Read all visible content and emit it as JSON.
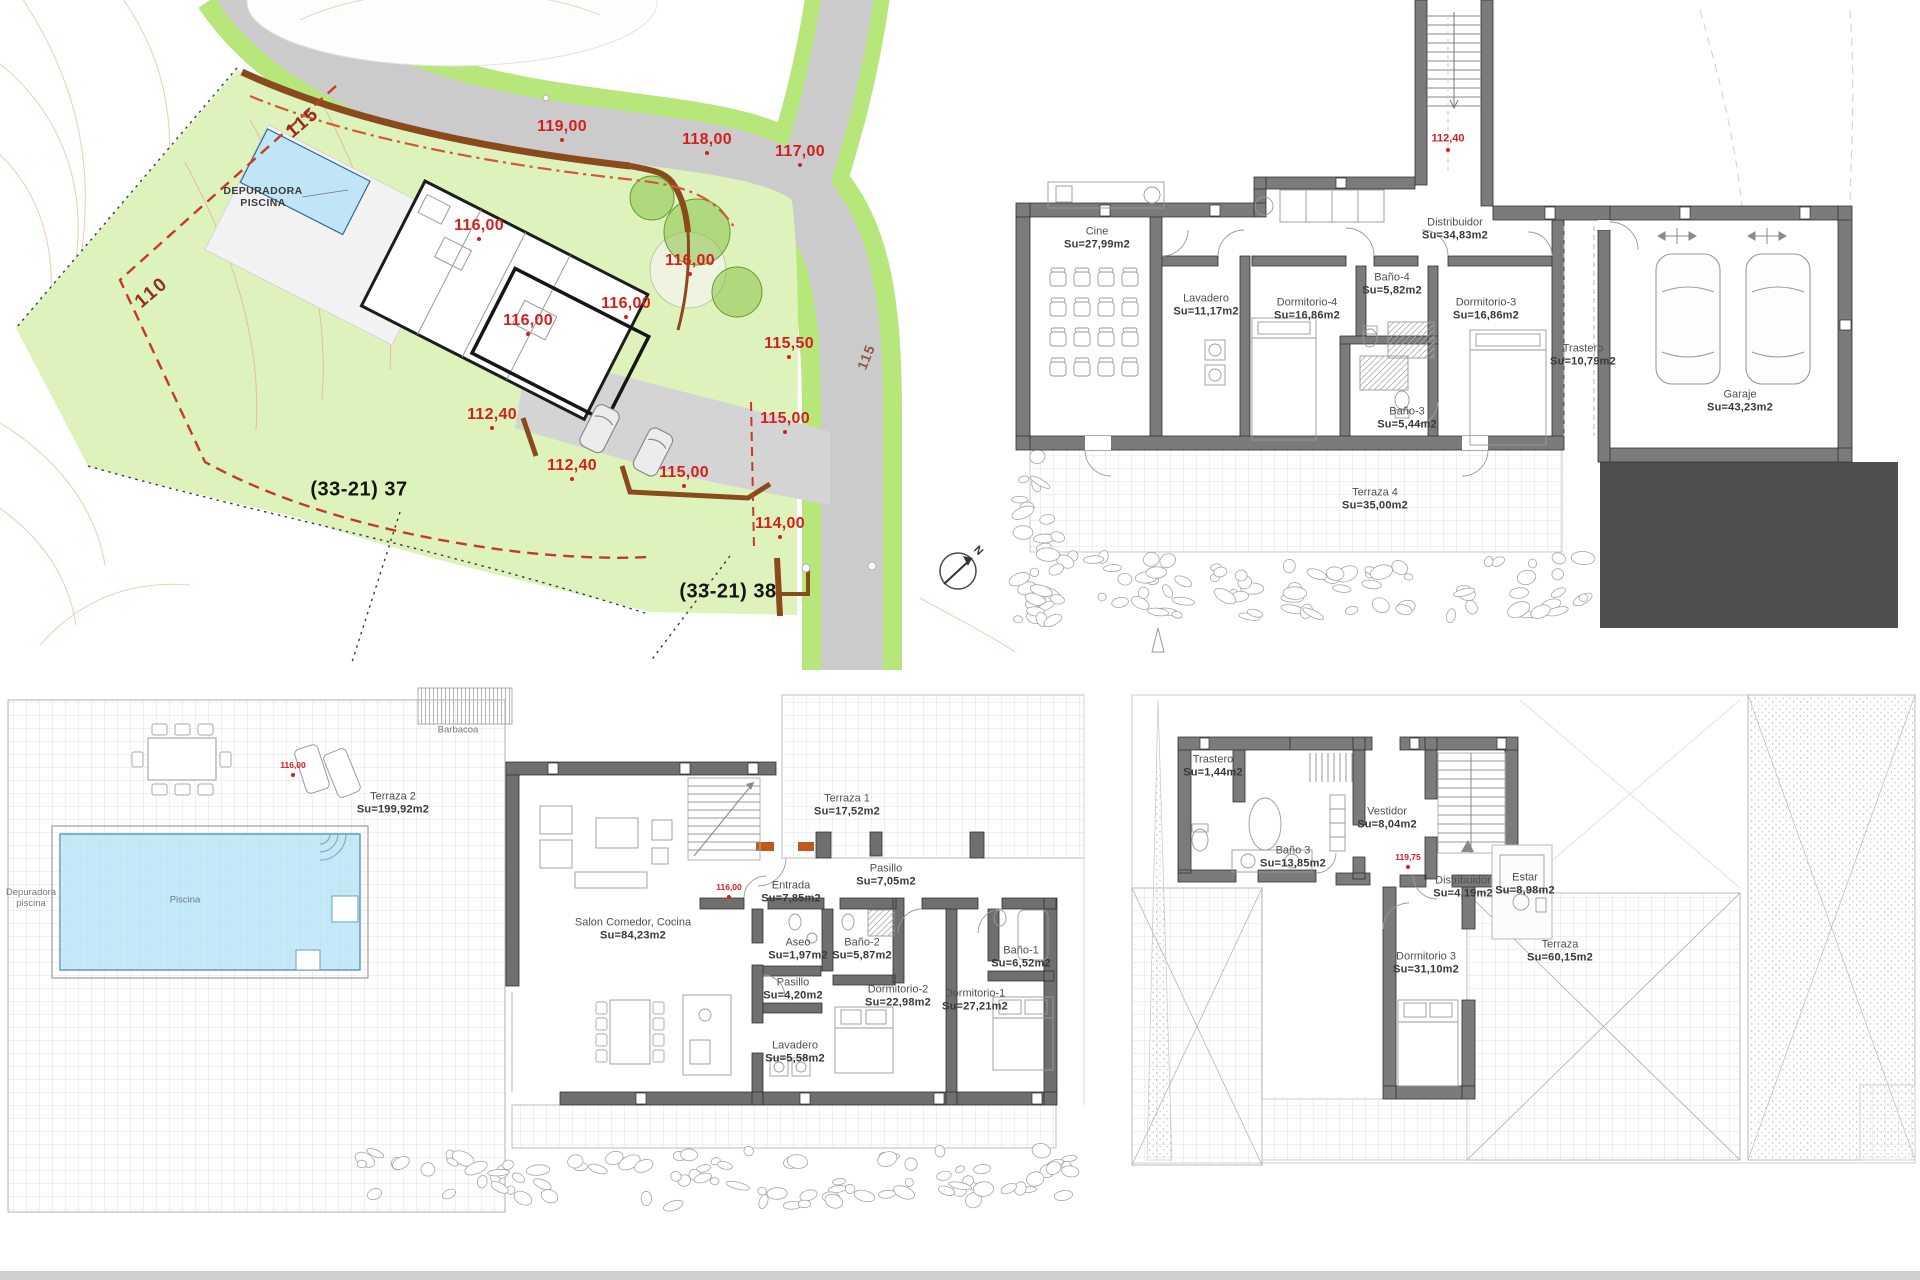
{
  "palette": {
    "plot_green": "#def2bb",
    "road_gray": "#cbcbcb",
    "verge_green": "#b7e67b",
    "pool_blue": "#bfe5f6",
    "wall_gray": "#7b7b7b",
    "retaining_brown": "#8a4a1c",
    "elevation_red": "#d42020",
    "boundary_red": "#c23b28",
    "dark_block": "#4f4f4f"
  },
  "labels": [
    {
      "t": "119,00",
      "x": 562,
      "y": 127,
      "c": "e",
      "n": "elevation-119"
    },
    {
      "t": "118,00",
      "x": 707,
      "y": 140,
      "c": "e",
      "n": "elevation-118"
    },
    {
      "t": "117,00",
      "x": 800,
      "y": 152,
      "c": "e",
      "n": "elevation-117"
    },
    {
      "t": "116,00",
      "x": 479,
      "y": 226,
      "c": "e",
      "n": "elevation-116-a"
    },
    {
      "t": "116,00",
      "x": 690,
      "y": 261,
      "c": "e",
      "n": "elevation-116-b"
    },
    {
      "t": "116,00",
      "x": 626,
      "y": 304,
      "c": "e",
      "n": "elevation-116-c"
    },
    {
      "t": "116,00",
      "x": 528,
      "y": 321,
      "c": "e",
      "n": "elevation-116-d"
    },
    {
      "t": "115,50",
      "x": 789,
      "y": 344,
      "c": "e",
      "n": "elevation-115-50"
    },
    {
      "t": "115,00",
      "x": 785,
      "y": 419,
      "c": "e",
      "n": "elevation-115-a"
    },
    {
      "t": "112,40",
      "x": 492,
      "y": 415,
      "c": "e",
      "n": "elevation-112-40-a"
    },
    {
      "t": "112,40",
      "x": 572,
      "y": 466,
      "c": "e",
      "n": "elevation-112-40-b"
    },
    {
      "t": "115,00",
      "x": 684,
      "y": 473,
      "c": "e",
      "n": "elevation-115-b"
    },
    {
      "t": "114,00",
      "x": 780,
      "y": 524,
      "c": "e",
      "n": "elevation-114"
    },
    {
      "t": "115",
      "x": 303,
      "y": 123,
      "c": "b",
      "r": -40,
      "n": "contour-label-115"
    },
    {
      "t": "110",
      "x": 152,
      "y": 293,
      "c": "b",
      "r": -40,
      "n": "contour-label-110"
    },
    {
      "t": "115",
      "x": 866,
      "y": 357,
      "c": "r",
      "r": -68,
      "n": "road-label-115"
    },
    {
      "t": "(33-21) 37",
      "x": 359,
      "y": 490,
      "c": "p",
      "n": "plot-label-37"
    },
    {
      "t": "(33-21) 38",
      "x": 728,
      "y": 592,
      "c": "p",
      "n": "plot-label-38"
    },
    {
      "t": "DEPURADORA\nPISCINA",
      "x": 263,
      "y": 197,
      "c": "cap",
      "n": "label-depuradora-piscina"
    },
    {
      "t": "N",
      "x": 978,
      "y": 551,
      "c": "n",
      "r": 45,
      "n": "north-label"
    },
    {
      "t": "112,40",
      "x": 1448,
      "y": 139,
      "c": "e2",
      "n": "elevation-112-40-basement"
    },
    {
      "t": "Cine\nSu=27,99m2",
      "x": 1097,
      "y": 238,
      "c": "room",
      "n": "label-cine"
    },
    {
      "t": "Distribuidor\nSu=34,83m2",
      "x": 1455,
      "y": 229,
      "c": "room",
      "n": "label-distribuidor-basement"
    },
    {
      "t": "Lavadero\nSu=11,17m2",
      "x": 1206,
      "y": 305,
      "c": "room",
      "n": "label-lavadero-basement"
    },
    {
      "t": "Dormitorio-4\nSu=16,86m2",
      "x": 1307,
      "y": 309,
      "c": "room",
      "n": "label-dormitorio-4"
    },
    {
      "t": "Baño-4\nSu=5,82m2",
      "x": 1392,
      "y": 284,
      "c": "room",
      "n": "label-bano-4"
    },
    {
      "t": "Dormitorio-3\nSu=16,86m2",
      "x": 1486,
      "y": 309,
      "c": "room",
      "n": "label-dormitorio-3-basement"
    },
    {
      "t": "Baño-3\nSu=5,44m2",
      "x": 1407,
      "y": 418,
      "c": "room",
      "n": "label-bano-3-basement"
    },
    {
      "t": "Trastero\nSu=10,79m2",
      "x": 1583,
      "y": 355,
      "c": "room",
      "n": "label-trastero-basement"
    },
    {
      "t": "Garaje\nSu=43,23m2",
      "x": 1740,
      "y": 401,
      "c": "room",
      "n": "label-garaje"
    },
    {
      "t": "Terraza 4\nSu=35,00m2",
      "x": 1375,
      "y": 499,
      "c": "room",
      "n": "label-terraza-4"
    },
    {
      "t": "Terraza 2\nSu=199,92m2",
      "x": 393,
      "y": 803,
      "c": "room",
      "n": "label-terraza-2"
    },
    {
      "t": "116,00",
      "x": 293,
      "y": 766,
      "c": "t",
      "n": "elevation-116-terraza"
    },
    {
      "t": "Barbacoa",
      "x": 458,
      "y": 731,
      "c": "small",
      "n": "label-barbacoa"
    },
    {
      "t": "Depuradora\npiscina",
      "x": 31,
      "y": 899,
      "c": "small",
      "n": "label-depuradora"
    },
    {
      "t": "Piscina",
      "x": 185,
      "y": 901,
      "c": "small",
      "n": "label-piscina"
    },
    {
      "t": "Terraza 1\nSu=17,52m2",
      "x": 847,
      "y": 805,
      "c": "room",
      "n": "label-terraza-1"
    },
    {
      "t": "116,00",
      "x": 729,
      "y": 888,
      "c": "t",
      "n": "elevation-116-house"
    },
    {
      "t": "Entrada\nSu=7,85m2",
      "x": 791,
      "y": 892,
      "c": "room",
      "n": "label-entrada"
    },
    {
      "t": "Pasillo\nSu=7,05m2",
      "x": 886,
      "y": 875,
      "c": "room",
      "n": "label-pasillo-1"
    },
    {
      "t": "Salon Comedor, Cocina\nSu=84,23m2",
      "x": 633,
      "y": 929,
      "c": "room",
      "n": "label-salon"
    },
    {
      "t": "Aseo\nSu=1,97m2",
      "x": 798,
      "y": 949,
      "c": "room",
      "n": "label-aseo"
    },
    {
      "t": "Baño-2\nSu=5,87m2",
      "x": 862,
      "y": 949,
      "c": "room",
      "n": "label-bano-2"
    },
    {
      "t": "Baño-1\nSu=6,52m2",
      "x": 1021,
      "y": 957,
      "c": "room",
      "n": "label-bano-1"
    },
    {
      "t": "Pasillo\nSu=4,20m2",
      "x": 793,
      "y": 989,
      "c": "room",
      "n": "label-pasillo-2"
    },
    {
      "t": "Dormitorio-2\nSu=22,98m2",
      "x": 898,
      "y": 996,
      "c": "room",
      "n": "label-dormitorio-2"
    },
    {
      "t": "Dormitorio-1\nSu=27,21m2",
      "x": 975,
      "y": 1000,
      "c": "room",
      "n": "label-dormitorio-1"
    },
    {
      "t": "Lavadero\nSu=5,58m2",
      "x": 795,
      "y": 1052,
      "c": "room",
      "n": "label-lavadero-main"
    },
    {
      "t": "Trastero\nSu=1,44m2",
      "x": 1213,
      "y": 766,
      "c": "room",
      "n": "label-trastero-top"
    },
    {
      "t": "Baño 3\nSu=13,85m2",
      "x": 1293,
      "y": 857,
      "c": "room",
      "n": "label-bano-3-top"
    },
    {
      "t": "Vestidor\nSu=8,04m2",
      "x": 1387,
      "y": 818,
      "c": "room",
      "n": "label-vestidor"
    },
    {
      "t": "119,75",
      "x": 1408,
      "y": 858,
      "c": "t",
      "n": "elevation-119-75"
    },
    {
      "t": "Distribuidor\nSu=4,19m2",
      "x": 1463,
      "y": 887,
      "c": "room",
      "n": "label-distribuidor-top"
    },
    {
      "t": "Estar\nSu=8,98m2",
      "x": 1525,
      "y": 884,
      "c": "room",
      "n": "label-estar"
    },
    {
      "t": "Dormitorio 3\nSu=31,10m2",
      "x": 1426,
      "y": 963,
      "c": "room",
      "n": "label-dormitorio-3-top"
    },
    {
      "t": "Terraza\nSu=60,15m2",
      "x": 1560,
      "y": 951,
      "c": "room",
      "n": "label-terraza-top"
    }
  ]
}
